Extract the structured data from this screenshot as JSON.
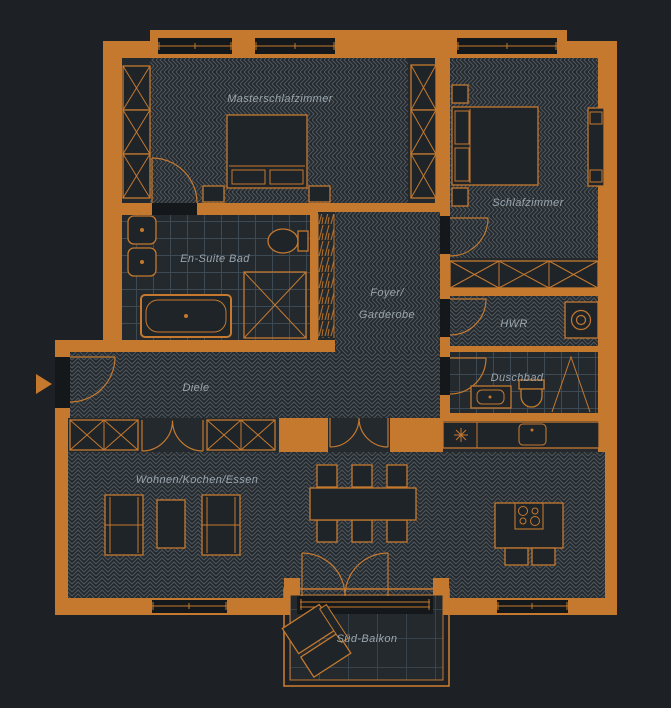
{
  "plan": {
    "rooms": {
      "masterschlafzimmer": {
        "label": "Masterschlafzimmer"
      },
      "schlafzimmer": {
        "label": "Schlafzimmer"
      },
      "ensuite_bad": {
        "label": "En-Suite Bad"
      },
      "foyer_garderobe": {
        "label_line1": "Foyer/",
        "label_line2": "Garderobe"
      },
      "hwr": {
        "label": "HWR"
      },
      "duschbad": {
        "label": "Duschbad"
      },
      "diele": {
        "label": "Diele"
      },
      "wohnen_kochen_essen": {
        "label": "Wohnen/Kochen/Essen"
      },
      "sued_balkon": {
        "label": "Süd-Balkon"
      }
    },
    "symbols": {
      "entrance": "arrow-right",
      "masterschlafzimmer": [
        "double-bed",
        "nightstands",
        "wardrobe-x-boxes",
        "door-arc"
      ],
      "schlafzimmer": [
        "double-bed",
        "nightstands",
        "bench",
        "wardrobe-x-boxes",
        "door-arc"
      ],
      "ensuite_bad": [
        "washbasins",
        "toilet",
        "bathtub",
        "shower-x",
        "tile-grid"
      ],
      "hwr": [
        "washing-machine",
        "door-arc"
      ],
      "duschbad": [
        "washbasin",
        "toilet",
        "shower-glass",
        "tile-grid",
        "door-arc"
      ],
      "wohnen_kochen_essen": [
        "sofas",
        "coffee-table",
        "dining-table-6-chairs",
        "kitchen-counter",
        "sink",
        "cooktop-star",
        "kitchen-island-hob",
        "bar-stools",
        "double-doors",
        "french-doors"
      ],
      "sued_balkon": [
        "lounge-furniture",
        "tile-grid"
      ]
    }
  },
  "colors": {
    "background": "#1d2125",
    "wall": "#c4792f",
    "floor": "#24292d",
    "hatch": "#4d565e",
    "tile": "#3d4953",
    "btile": "#39434c",
    "slot": "#15181b",
    "furniture": "#1f2428",
    "label": "#9aa5ae"
  }
}
